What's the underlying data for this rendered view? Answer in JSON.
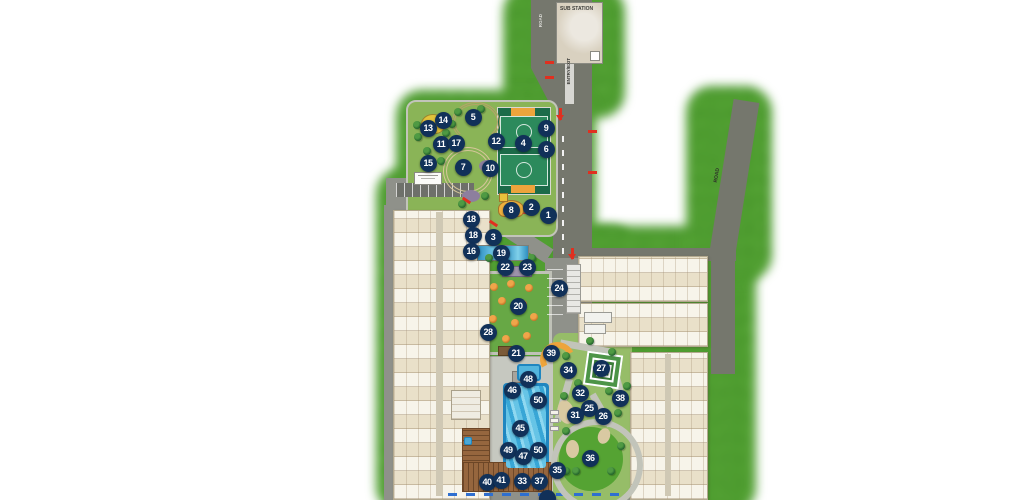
{
  "labels": {
    "sub_station": "SUB STATION",
    "road_top": "ROAD",
    "entry_exit": "ENTRY/EXIT",
    "road_right": "ROAD"
  },
  "colors": {
    "marker_navy": "#113159",
    "grass_green": "#4f9e30",
    "road_gray": "#75776d",
    "court_green": "#1c6b49",
    "pool_blue": "#2f9ed0",
    "accent_orange": "#eda43c",
    "lawn_green": "#67a845",
    "building_cream": "#f3efe3"
  },
  "markers": [
    {
      "n": "13",
      "x": 428,
      "y": 128
    },
    {
      "n": "14",
      "x": 443,
      "y": 120
    },
    {
      "n": "5",
      "x": 473,
      "y": 117
    },
    {
      "n": "9",
      "x": 546,
      "y": 128
    },
    {
      "n": "11",
      "x": 441,
      "y": 144
    },
    {
      "n": "17",
      "x": 456,
      "y": 143
    },
    {
      "n": "12",
      "x": 496,
      "y": 141
    },
    {
      "n": "4",
      "x": 523,
      "y": 143
    },
    {
      "n": "6",
      "x": 546,
      "y": 149
    },
    {
      "n": "15",
      "x": 428,
      "y": 163
    },
    {
      "n": "7",
      "x": 463,
      "y": 167
    },
    {
      "n": "10",
      "x": 490,
      "y": 168
    },
    {
      "n": "8",
      "x": 511,
      "y": 210
    },
    {
      "n": "2",
      "x": 531,
      "y": 207
    },
    {
      "n": "1",
      "x": 548,
      "y": 215
    },
    {
      "n": "18",
      "x": 471,
      "y": 219
    },
    {
      "n": "18",
      "x": 473,
      "y": 235
    },
    {
      "n": "3",
      "x": 493,
      "y": 237
    },
    {
      "n": "16",
      "x": 471,
      "y": 251
    },
    {
      "n": "19",
      "x": 501,
      "y": 253
    },
    {
      "n": "22",
      "x": 505,
      "y": 267
    },
    {
      "n": "23",
      "x": 527,
      "y": 267
    },
    {
      "n": "24",
      "x": 559,
      "y": 288
    },
    {
      "n": "20",
      "x": 518,
      "y": 306
    },
    {
      "n": "28",
      "x": 488,
      "y": 332
    },
    {
      "n": "21",
      "x": 516,
      "y": 353
    },
    {
      "n": "39",
      "x": 551,
      "y": 353
    },
    {
      "n": "34",
      "x": 568,
      "y": 370
    },
    {
      "n": "27",
      "x": 601,
      "y": 368
    },
    {
      "n": "48",
      "x": 528,
      "y": 379
    },
    {
      "n": "46",
      "x": 512,
      "y": 390
    },
    {
      "n": "32",
      "x": 580,
      "y": 393
    },
    {
      "n": "38",
      "x": 620,
      "y": 398
    },
    {
      "n": "50",
      "x": 538,
      "y": 400
    },
    {
      "n": "25",
      "x": 589,
      "y": 408
    },
    {
      "n": "31",
      "x": 575,
      "y": 415
    },
    {
      "n": "26",
      "x": 603,
      "y": 416
    },
    {
      "n": "45",
      "x": 520,
      "y": 428
    },
    {
      "n": "49",
      "x": 508,
      "y": 450
    },
    {
      "n": "50",
      "x": 538,
      "y": 450
    },
    {
      "n": "47",
      "x": 523,
      "y": 456
    },
    {
      "n": "36",
      "x": 590,
      "y": 458
    },
    {
      "n": "35",
      "x": 557,
      "y": 470
    },
    {
      "n": "40",
      "x": 487,
      "y": 482
    },
    {
      "n": "41",
      "x": 501,
      "y": 480
    },
    {
      "n": "33",
      "x": 522,
      "y": 481
    },
    {
      "n": "37",
      "x": 539,
      "y": 481
    },
    {
      "n": "",
      "x": 547,
      "y": 498
    }
  ]
}
